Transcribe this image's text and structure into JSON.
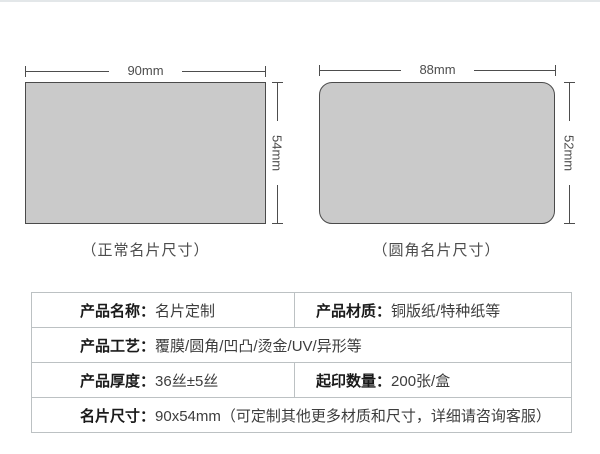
{
  "page": {
    "background": "#ffffff",
    "top_divider_color": "#e3e7e9"
  },
  "cards": {
    "normal": {
      "shape": "rectangle",
      "fill": "#cacaca",
      "border": "#4a4a4a",
      "width_label": "90mm",
      "height_label": "54mm",
      "caption": "（正常名片尺寸）"
    },
    "rounded": {
      "shape": "rounded-rectangle",
      "fill": "#cacaca",
      "border": "#4a4a4a",
      "width_label": "88mm",
      "height_label": "52mm",
      "caption": "（圆角名片尺寸）"
    }
  },
  "spec_table": {
    "colon": "：",
    "border_color": "#bcc1c3",
    "rows": [
      {
        "cells": [
          {
            "label": "产品名称",
            "value": "名片定制"
          },
          {
            "label": "产品材质",
            "value": "铜版纸/特种纸等"
          }
        ]
      },
      {
        "cells": [
          {
            "label": "产品工艺",
            "value": "覆膜/圆角/凹凸/烫金/UV/异形等"
          }
        ]
      },
      {
        "cells": [
          {
            "label": "产品厚度",
            "value": "36丝±5丝"
          },
          {
            "label": "起印数量",
            "value": "200张/盒"
          }
        ]
      },
      {
        "cells": [
          {
            "label": "名片尺寸",
            "value": "90x54mm（可定制其他更多材质和尺寸，详细请咨询客服）"
          }
        ]
      }
    ]
  }
}
